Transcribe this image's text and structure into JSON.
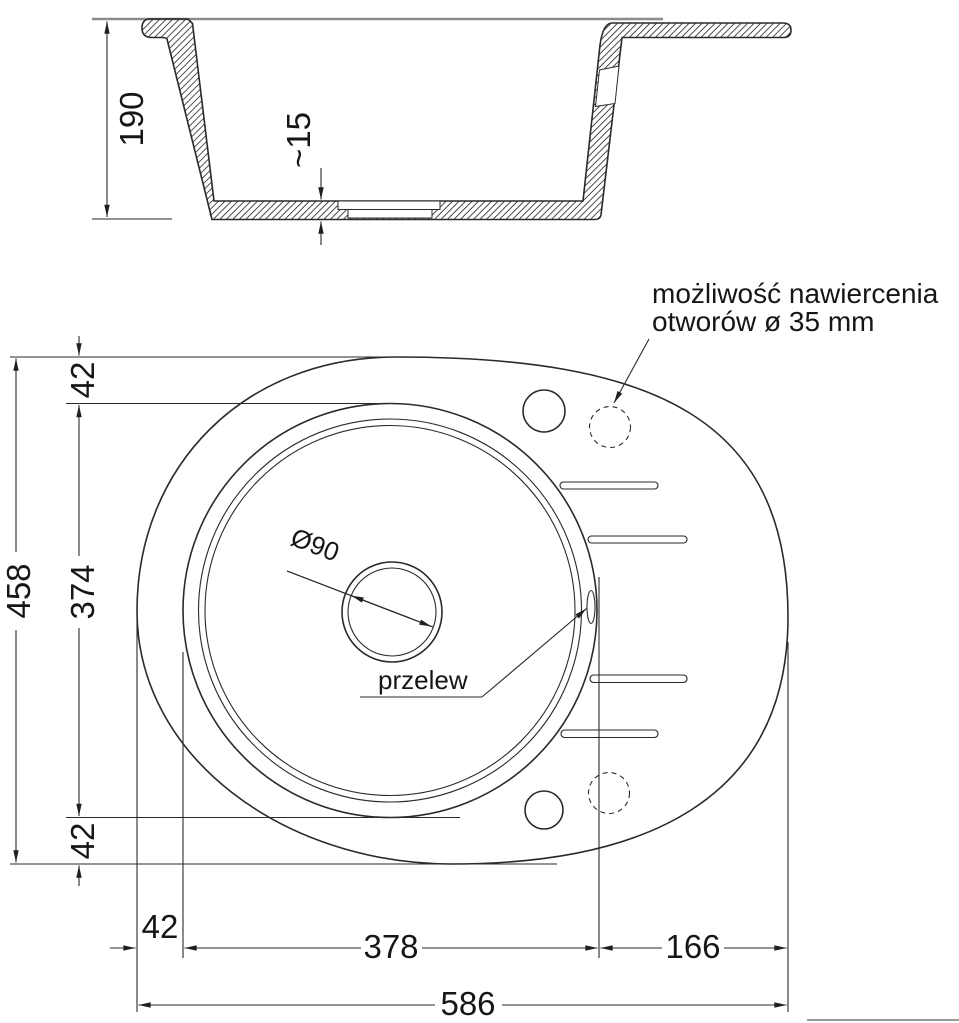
{
  "cross_section": {
    "height": "190",
    "bottom_thickness": "~15"
  },
  "plan": {
    "width_total": "586",
    "width_left_edge": "42",
    "width_bowl": "378",
    "width_drainer": "166",
    "height_total": "458",
    "height_top_edge": "42",
    "height_bowl": "374",
    "height_bottom_edge": "42",
    "drain_diameter": "Ø90"
  },
  "labels": {
    "overflow": "przelew",
    "drill_note_line1": "możliwość nawiercenia",
    "drill_note_line2": "otworów ø 35 mm"
  },
  "colors": {
    "line": "#2a2a2a",
    "countertop": "#8c8c8c",
    "background": "#ffffff"
  }
}
